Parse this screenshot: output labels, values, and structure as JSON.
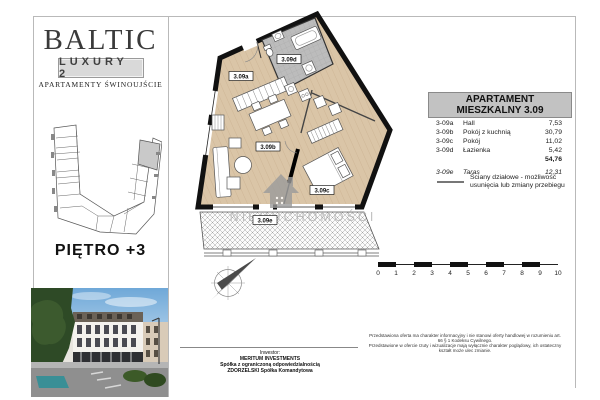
{
  "sidebar": {
    "brand": "BALTIC",
    "brand_sub": "LUXURY 2",
    "brand_tagline": "APARTAMENTY ŚWINOUJŚCIE",
    "floor_label": "PIĘTRO +3"
  },
  "plan": {
    "room_labels": {
      "a": "3.09a",
      "b": "3.09b",
      "c": "3.09c",
      "d": "3.09d",
      "e": "3.09e"
    },
    "watermark": "NIERUCHOMOŚCI"
  },
  "panel": {
    "header_line1": "APARTAMENT",
    "header_line2": "MIESZKALNY 3.09",
    "rows": [
      {
        "code": "3-09a",
        "name": "Hall",
        "area": "7,53"
      },
      {
        "code": "3-09b",
        "name": "Pokój z kuchnią",
        "area": "30,79"
      },
      {
        "code": "3-09c",
        "name": "Pokój",
        "area": "11,02"
      },
      {
        "code": "3-09d",
        "name": "Łazienka",
        "area": "5,42"
      }
    ],
    "total": "54,76",
    "terrace_row": {
      "code": "3-09e",
      "name": "Taras",
      "area": "12,31"
    },
    "legend": "Ściany działowe - możliwość usunięcia lub zmiany przebiegu"
  },
  "scale_bar": {
    "labels": [
      "0",
      "1",
      "2",
      "3",
      "4",
      "5",
      "6",
      "7",
      "8",
      "9",
      "10"
    ]
  },
  "footer": {
    "investor_label": "Inwestor:",
    "investor_line1": "MERITUM INVESTMENTS",
    "investor_line2": "Spółka z ograniczoną odpowiedzialnością",
    "investor_line3": "ZDORZELSKI Spółka Komandytowa",
    "disclaimer_line1": "Przedstawiona oferta ma charakter informacyjny i nie stanowi oferty handlowej w rozumieniu art. 66 § 1 Kodeksu Cywilnego.",
    "disclaimer_line2": "Przedstawione w ofercie rzuty i wizualizacje mają wyłącznie charakter poglądowy, ich ostateczny kształt może ulec zmianie."
  },
  "colors": {
    "wall": "#111111",
    "floor_wood": "#dac5a7",
    "bathroom_tile": "#bcbcbc",
    "header_bg": "#c2c2c2",
    "highlight_unit": "#c9c9c9"
  }
}
